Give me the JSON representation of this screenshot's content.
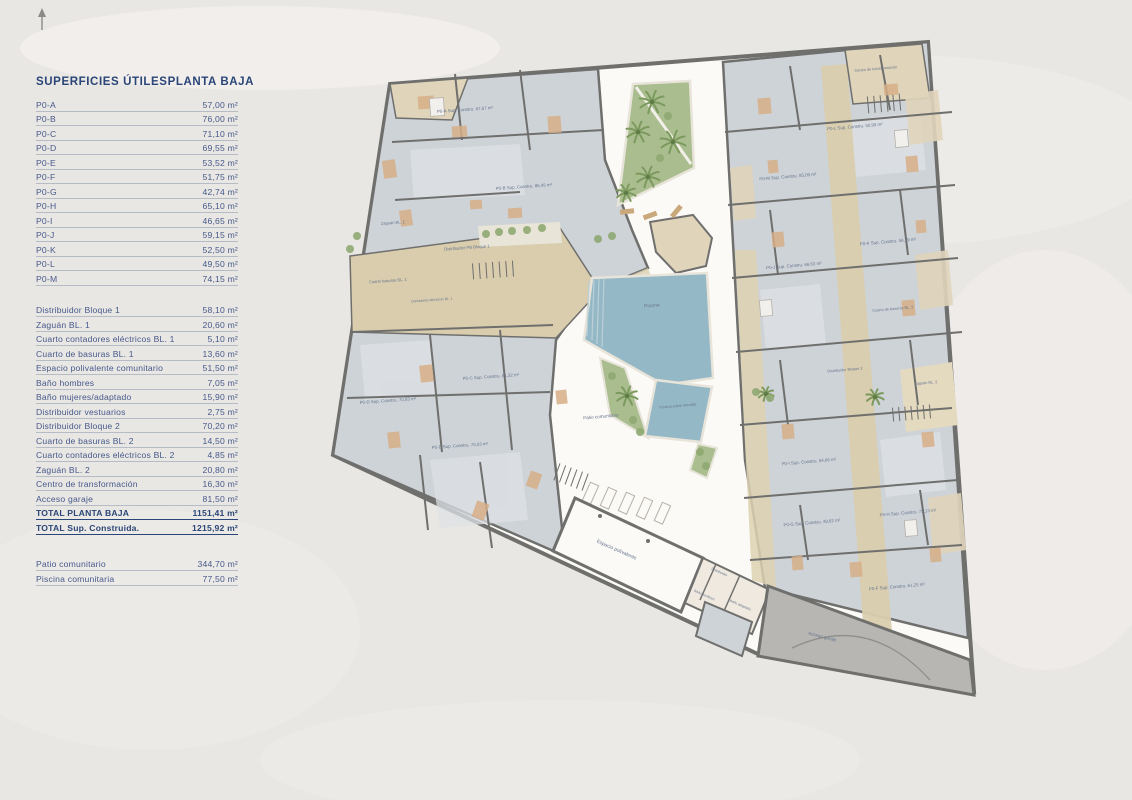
{
  "panel": {
    "header": {
      "left": "SUPERFICIES ÚTILES",
      "right": "PLANTA BAJA"
    },
    "units": [
      {
        "label": "P0-A",
        "value": "57,00 m²"
      },
      {
        "label": "P0-B",
        "value": "76,00 m²"
      },
      {
        "label": "P0-C",
        "value": "71,10 m²"
      },
      {
        "label": "P0-D",
        "value": "69,55 m²"
      },
      {
        "label": "P0-E",
        "value": "53,52 m²"
      },
      {
        "label": "P0-F",
        "value": "51,75 m²"
      },
      {
        "label": "P0-G",
        "value": "42,74 m²"
      },
      {
        "label": "P0-H",
        "value": "65,10 m²"
      },
      {
        "label": "P0-I",
        "value": "46,65 m²"
      },
      {
        "label": "P0-J",
        "value": "59,15 m²"
      },
      {
        "label": "P0-K",
        "value": "52,50 m²"
      },
      {
        "label": "P0-L",
        "value": "49,50 m²"
      },
      {
        "label": "P0-M",
        "value": "74,15 m²"
      }
    ],
    "common": [
      {
        "label": "Distribuidor Bloque 1",
        "value": "58,10 m²"
      },
      {
        "label": "Zaguán BL. 1",
        "value": "20,60 m²"
      },
      {
        "label": "Cuarto contadores eléctricos BL. 1",
        "value": "5,10 m²"
      },
      {
        "label": "Cuarto de basuras BL. 1",
        "value": "13,60 m²"
      },
      {
        "label": "Espacio polivalente comunitario",
        "value": "51,50 m²"
      },
      {
        "label": "Baño hombres",
        "value": "7,05 m²"
      },
      {
        "label": "Baño mujeres/adaptado",
        "value": "15,90 m²"
      },
      {
        "label": "Distribuidor vestuarios",
        "value": "2,75 m²"
      },
      {
        "label": "Distribuidor Bloque 2",
        "value": "70,20 m²"
      },
      {
        "label": "Cuarto de basuras BL. 2",
        "value": "14,50 m²"
      },
      {
        "label": "Cuarto contadores eléctricos BL. 2",
        "value": "4,85 m²"
      },
      {
        "label": "Zaguán BL. 2",
        "value": "20,80 m²"
      },
      {
        "label": "Centro de transformación",
        "value": "16,30 m²"
      },
      {
        "label": "Acceso garaje",
        "value": "81,50 m²"
      }
    ],
    "totals": [
      {
        "label": "TOTAL PLANTA BAJA",
        "value": "1151,41 m²"
      },
      {
        "label": "TOTAL Sup. Construida.",
        "value": "1215,92 m²"
      }
    ],
    "outdoor": [
      {
        "label": "Patio comunitario",
        "value": "344,70 m²"
      },
      {
        "label": "Piscina comunitaria",
        "value": "77,50 m²"
      }
    ]
  },
  "plan": {
    "labels": [
      "P0-A Sup. Constru. 67,67 m²",
      "P0-B Sup. Constru. 86,45 m²",
      "P0-C Sup. Constru. 81,32 m²",
      "P0-D Sup. Constru. 70,93 m²",
      "P0-E Sup. Constru. 70,03 m²",
      "P0-F Sup. Constru. 61,25 m²",
      "P0-G Sup. Constru. 49,82 m²",
      "P0-H Sup. Constru. 75,13 m²",
      "P0-I Sup. Constru. 54,86 m²",
      "P0-J Sup. Constru. 66,63 m²",
      "P0-K Sup. Constru. 58,79 m²",
      "P0-L Sup. Constru. 50,99 m²",
      "P0-M Sup. Constru. 85,09 m²",
      "Zaguán BL. 1",
      "Distribuidor PB Bloque 1",
      "Cuarto basuras BL. 1",
      "Contadores eléctricos BL. 1",
      "Centro de transformación",
      "Zaguán BL. 2",
      "Distribuidor Bloque 2",
      "Cuarto de basuras BL. 2",
      "Patio comunitario",
      "Piscina",
      "Piscina sobre elevada",
      "Espacio polivalente",
      "Distribuidor",
      "Baño hombres",
      "Baño adaptado",
      "Acceso garaje"
    ],
    "colors": {
      "room_gray": "#ced3d8",
      "room_light": "#dde1e5",
      "circulation_beige": "#d9cdae",
      "terrace_beige": "#e0d4ba",
      "pool_blue": "#95b8c6",
      "garden_green": "#a9bd8f",
      "palm_green": "#7c9a5e",
      "ramp_gray": "#b7b6b3",
      "wall": "#6f6f6d",
      "courtyard_white": "#fbfaf7",
      "navy": "#2a4577"
    }
  }
}
